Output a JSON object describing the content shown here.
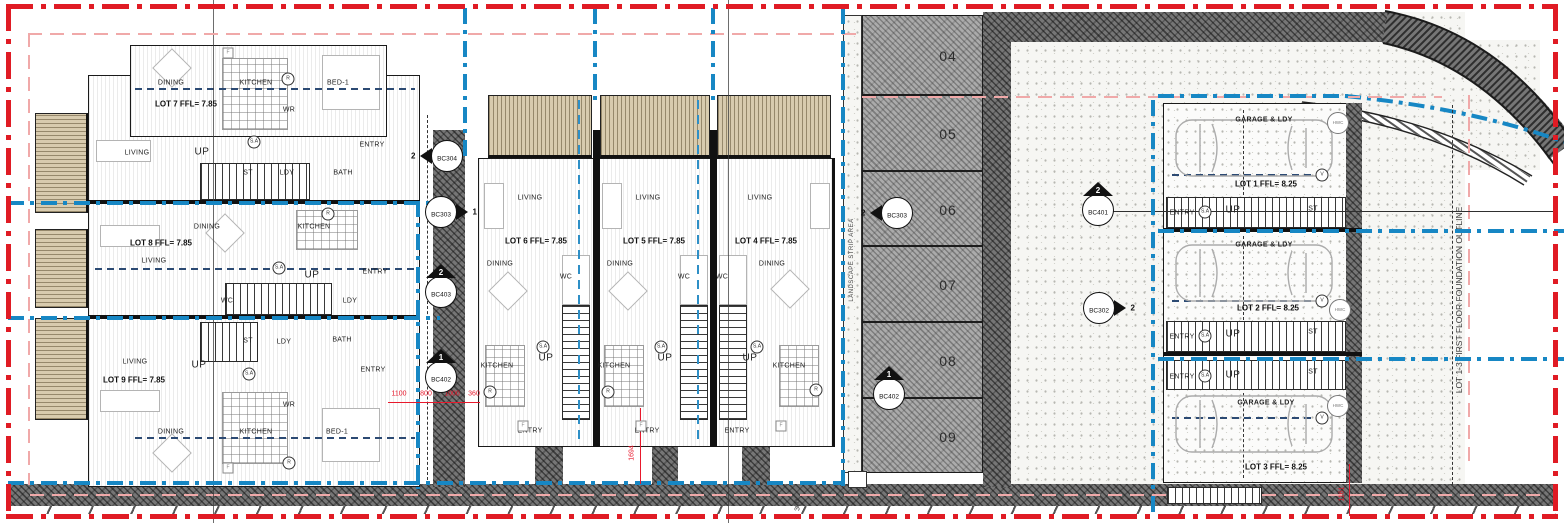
{
  "drawing": {
    "type": "site floor plan",
    "colors": {
      "boundary_red": "#e01b24",
      "lot_boundary_blue": "#1787c4",
      "dimension_red": "#e8192c",
      "setback_pink": "#f0a9a9",
      "wall_dark": "#767676",
      "deck_tan": "#d8cbae",
      "centerline_navy": "#2c4a73"
    }
  },
  "lot_titles": [
    {
      "t": "LOT 7 FFL= 7.85",
      "x": 186,
      "y": 104
    },
    {
      "t": "LOT 8 FFL= 7.85",
      "x": 161,
      "y": 243
    },
    {
      "t": "LOT 9 FFL= 7.85",
      "x": 134,
      "y": 380
    },
    {
      "t": "LOT 6 FFL= 7.85",
      "x": 536,
      "y": 241
    },
    {
      "t": "LOT 5 FFL= 7.85",
      "x": 654,
      "y": 241
    },
    {
      "t": "LOT 4 FFL= 7.85",
      "x": 766,
      "y": 241
    },
    {
      "t": "LOT 1 FFL= 8.25",
      "x": 1266,
      "y": 184
    },
    {
      "t": "LOT 2 FFL= 8.25",
      "x": 1268,
      "y": 308
    },
    {
      "t": "LOT 3 FFL= 8.25",
      "x": 1276,
      "y": 467
    }
  ],
  "garage_titles": [
    {
      "t": "GARAGE & LDY",
      "x": 1264,
      "y": 120
    },
    {
      "t": "GARAGE & LDY",
      "x": 1264,
      "y": 245
    },
    {
      "t": "GARAGE & LDY",
      "x": 1266,
      "y": 403
    }
  ],
  "room_labels": [
    {
      "t": "DINING",
      "x": 171,
      "y": 83
    },
    {
      "t": "KITCHEN",
      "x": 256,
      "y": 83
    },
    {
      "t": "BED-1",
      "x": 338,
      "y": 83
    },
    {
      "t": "WR",
      "x": 289,
      "y": 110
    },
    {
      "t": "LIVING",
      "x": 137,
      "y": 153
    },
    {
      "t": "UP",
      "x": 202,
      "y": 152,
      "cls": "up"
    },
    {
      "t": "ST",
      "x": 248,
      "y": 173
    },
    {
      "t": "LDY",
      "x": 287,
      "y": 173
    },
    {
      "t": "BATH",
      "x": 343,
      "y": 173
    },
    {
      "t": "ENTRY",
      "x": 372,
      "y": 145
    },
    {
      "t": "DINING",
      "x": 207,
      "y": 227
    },
    {
      "t": "KITCHEN",
      "x": 314,
      "y": 227
    },
    {
      "t": "LIVING",
      "x": 154,
      "y": 261
    },
    {
      "t": "UP",
      "x": 312,
      "y": 275,
      "cls": "up"
    },
    {
      "t": "WC",
      "x": 227,
      "y": 301
    },
    {
      "t": "LDY",
      "x": 350,
      "y": 301
    },
    {
      "t": "ENTRY",
      "x": 375,
      "y": 272
    },
    {
      "t": "LIVING",
      "x": 135,
      "y": 362
    },
    {
      "t": "ST",
      "x": 248,
      "y": 341
    },
    {
      "t": "LDY",
      "x": 284,
      "y": 342
    },
    {
      "t": "BATH",
      "x": 342,
      "y": 340
    },
    {
      "t": "UP",
      "x": 199,
      "y": 365,
      "cls": "up"
    },
    {
      "t": "ENTRY",
      "x": 373,
      "y": 370
    },
    {
      "t": "WR",
      "x": 289,
      "y": 405
    },
    {
      "t": "DINING",
      "x": 171,
      "y": 432
    },
    {
      "t": "KITCHEN",
      "x": 256,
      "y": 432
    },
    {
      "t": "BED-1",
      "x": 337,
      "y": 432
    },
    {
      "t": "LIVING",
      "x": 530,
      "y": 198
    },
    {
      "t": "DINING",
      "x": 500,
      "y": 264
    },
    {
      "t": "WC",
      "x": 566,
      "y": 277
    },
    {
      "t": "UP",
      "x": 546,
      "y": 358,
      "cls": "up"
    },
    {
      "t": "KITCHEN",
      "x": 497,
      "y": 366
    },
    {
      "t": "ENTRY",
      "x": 530,
      "y": 431
    },
    {
      "t": "LIVING",
      "x": 648,
      "y": 198
    },
    {
      "t": "DINING",
      "x": 620,
      "y": 264
    },
    {
      "t": "WC",
      "x": 684,
      "y": 277
    },
    {
      "t": "UP",
      "x": 665,
      "y": 358,
      "cls": "up"
    },
    {
      "t": "KITCHEN",
      "x": 614,
      "y": 366
    },
    {
      "t": "ENTRY",
      "x": 647,
      "y": 431
    },
    {
      "t": "LIVING",
      "x": 760,
      "y": 198
    },
    {
      "t": "DINING",
      "x": 772,
      "y": 264
    },
    {
      "t": "WC",
      "x": 722,
      "y": 277
    },
    {
      "t": "UP",
      "x": 750,
      "y": 358,
      "cls": "up"
    },
    {
      "t": "KITCHEN",
      "x": 789,
      "y": 366
    },
    {
      "t": "ENTRY",
      "x": 737,
      "y": 431
    },
    {
      "t": "ENTRY",
      "x": 1182,
      "y": 213
    },
    {
      "t": "UP",
      "x": 1233,
      "y": 210,
      "cls": "up"
    },
    {
      "t": "ST",
      "x": 1313,
      "y": 209
    },
    {
      "t": "ENTRY",
      "x": 1182,
      "y": 337
    },
    {
      "t": "UP",
      "x": 1233,
      "y": 334,
      "cls": "up"
    },
    {
      "t": "ST",
      "x": 1313,
      "y": 332
    },
    {
      "t": "ENTRY",
      "x": 1182,
      "y": 377
    },
    {
      "t": "UP",
      "x": 1233,
      "y": 375,
      "cls": "up"
    },
    {
      "t": "ST",
      "x": 1313,
      "y": 372
    }
  ],
  "annotations": [
    {
      "t": "R",
      "x": 288,
      "y": 79
    },
    {
      "t": "R",
      "x": 328,
      "y": 214
    },
    {
      "t": "R",
      "x": 289,
      "y": 463
    },
    {
      "t": "R",
      "x": 490,
      "y": 392
    },
    {
      "t": "R",
      "x": 608,
      "y": 392
    },
    {
      "t": "R",
      "x": 816,
      "y": 390
    },
    {
      "t": "V",
      "x": 1322,
      "y": 175
    },
    {
      "t": "V",
      "x": 1322,
      "y": 301
    },
    {
      "t": "V",
      "x": 1322,
      "y": 418
    },
    {
      "t": "S.A",
      "x": 254,
      "y": 142
    },
    {
      "t": "S.A",
      "x": 279,
      "y": 268
    },
    {
      "t": "S.A",
      "x": 249,
      "y": 374
    },
    {
      "t": "S.A",
      "x": 543,
      "y": 347
    },
    {
      "t": "S.A",
      "x": 661,
      "y": 347
    },
    {
      "t": "S.A",
      "x": 757,
      "y": 347
    },
    {
      "t": "S.A",
      "x": 1205,
      "y": 212,
      "cls": "ga"
    },
    {
      "t": "S.A",
      "x": 1205,
      "y": 336,
      "cls": "ga"
    },
    {
      "t": "S.A",
      "x": 1205,
      "y": 376,
      "cls": "ga"
    },
    {
      "t": "F",
      "x": 228,
      "y": 53,
      "cls": "sq"
    },
    {
      "t": "F",
      "x": 228,
      "y": 468,
      "cls": "sq"
    },
    {
      "t": "F",
      "x": 523,
      "y": 426,
      "cls": "sq"
    },
    {
      "t": "F",
      "x": 641,
      "y": 426,
      "cls": "sq"
    },
    {
      "t": "F",
      "x": 781,
      "y": 426,
      "cls": "sq"
    },
    {
      "t": "HWC",
      "x": 1338,
      "y": 123,
      "cls": "hwc"
    },
    {
      "t": "HWC",
      "x": 1340,
      "y": 310,
      "cls": "hwc"
    },
    {
      "t": "HWC",
      "x": 1338,
      "y": 406,
      "cls": "hwc"
    }
  ],
  "strip": {
    "label": "LANDSCAPE STRIP AREA",
    "cells": [
      {
        "t": "04",
        "y": 15,
        "h": 80
      },
      {
        "t": "05",
        "y": 95,
        "h": 76
      },
      {
        "t": "06",
        "y": 171,
        "h": 75
      },
      {
        "t": "07",
        "y": 246,
        "h": 76
      },
      {
        "t": "08",
        "y": 322,
        "h": 76
      },
      {
        "t": "09",
        "y": 398,
        "h": 75
      }
    ]
  },
  "markers": [
    {
      "label": "BC304",
      "num": "2",
      "dir": "left"
    },
    {
      "label": "BC303",
      "num": "1",
      "dir": "right"
    },
    {
      "label": "BC403",
      "num": "2",
      "dir": "up"
    },
    {
      "label": "BC402",
      "num": "1",
      "dir": "up"
    },
    {
      "label": "BC303",
      "num": "2",
      "dir": "left"
    },
    {
      "label": "BC402",
      "num": "1",
      "dir": "up"
    },
    {
      "label": "BC401",
      "num": "2",
      "dir": "up"
    },
    {
      "label": "BC302",
      "num": "2",
      "dir": "right"
    }
  ],
  "dimensions": {
    "horizontal_row": [
      {
        "t": "1100",
        "x": 399
      },
      {
        "t": "800",
        "x": 426
      },
      {
        "t": "1000",
        "x": 452
      },
      {
        "t": "360",
        "x": 474
      }
    ],
    "vertical": [
      {
        "t": "1694",
        "x": 632,
        "y": 453
      },
      {
        "t": "1161",
        "x": 1342,
        "y": 494
      },
      {
        "t": "771",
        "x": 857,
        "y": 479,
        "cls": "dark"
      },
      {
        "t": "300",
        "x": 798,
        "y": 505,
        "cls": "dark"
      }
    ]
  },
  "notes": {
    "foundation_outline": "LOT 1-3 FIRST FLOOR FOUNDATION OUTLINE"
  }
}
